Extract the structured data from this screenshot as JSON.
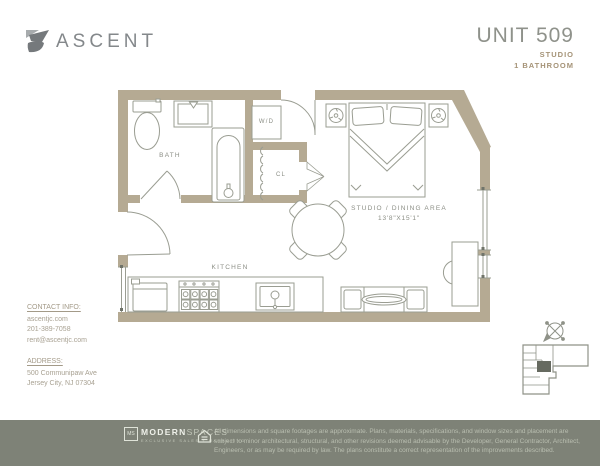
{
  "brand": {
    "name": "ASCENT",
    "logo_icon": "ascent-mark"
  },
  "unit": {
    "number": "UNIT 509",
    "type": "STUDIO",
    "bathrooms": "1 BATHROOM"
  },
  "plan": {
    "labels": {
      "bath": "BATH",
      "washer_dryer": "W/D",
      "closet": "CL",
      "kitchen": "KITCHEN",
      "studio": "STUDIO / DINING AREA",
      "studio_dimensions": "13'8\"X15'1\""
    },
    "icons": [
      "compass-icon",
      "key-plan"
    ]
  },
  "contact": {
    "heading": "CONTACT INFO:",
    "website": "ascentjc.com",
    "phone": "201-389-7058",
    "email": "rent@ascentjc.com",
    "address_heading": "ADDRESS:",
    "address_line1": "500 Communipaw Ave",
    "address_line2": "Jersey City, NJ 07304"
  },
  "footer": {
    "logo_box": "MS",
    "logo_main": "MODERN",
    "logo_light": "SPACES",
    "logo_sub": "EXCLUSIVE SALES + MARKETING",
    "equal_housing_icon": "equal-housing-house",
    "disclaimer": "All dimensions and square footages are approximate. Plans, materials, specifications, and window sizes and placement are subject to minor architectural, structural, and other revisions deemed advisable by the Developer, General Contractor, Architect, Engineers, or as may be required by law. The plans constitute a correct representation of the improvements described."
  },
  "colors": {
    "wall": "#b5aa93",
    "line": "#9a9d92",
    "accent_tan": "#a59377",
    "footer_bg": "#7e8277",
    "text_gray": "#8b8e85"
  }
}
